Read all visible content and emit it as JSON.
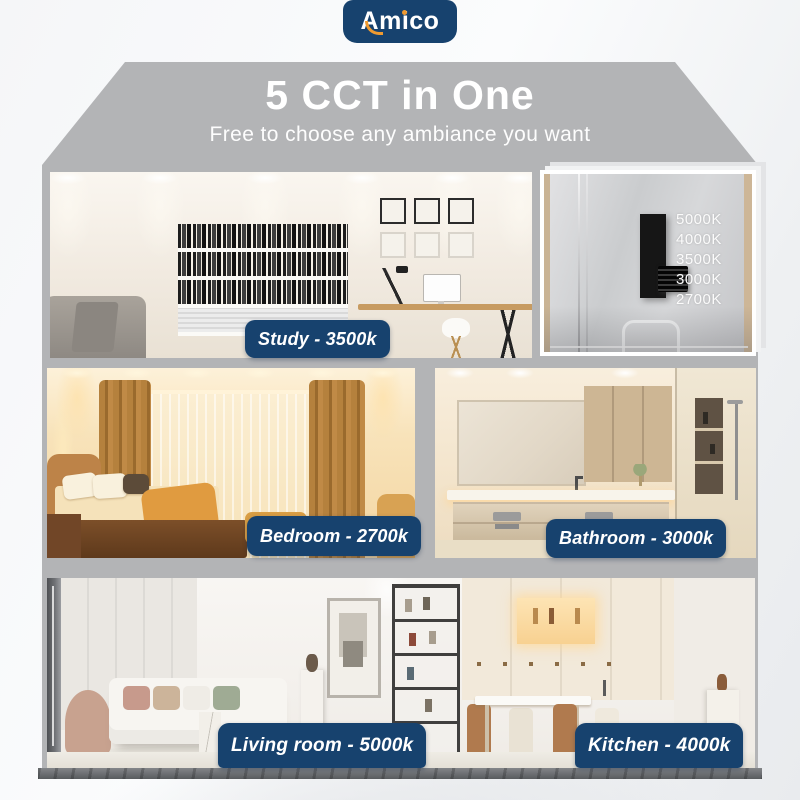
{
  "brand": {
    "name": "Amico"
  },
  "header": {
    "title": "5 CCT in One",
    "subtitle": "Free to choose any ambiance you want"
  },
  "cct_switch": {
    "options": [
      "5000K",
      "4000K",
      "3500K",
      "3000K",
      "2700K"
    ],
    "knob_position": "3000K"
  },
  "rooms": [
    {
      "label": "Study - 3500k"
    },
    {
      "label": "Bedroom - 2700k"
    },
    {
      "label": "Bathroom - 3000k"
    },
    {
      "label": "Living room - 5000k"
    },
    {
      "label": "Kitchen - 4000k"
    }
  ],
  "colors": {
    "navy": "#17426e",
    "house_gray": "#b3b4b6",
    "logo_accent_orange": "#ef9a30",
    "foundation_gray": "#686b6f"
  }
}
